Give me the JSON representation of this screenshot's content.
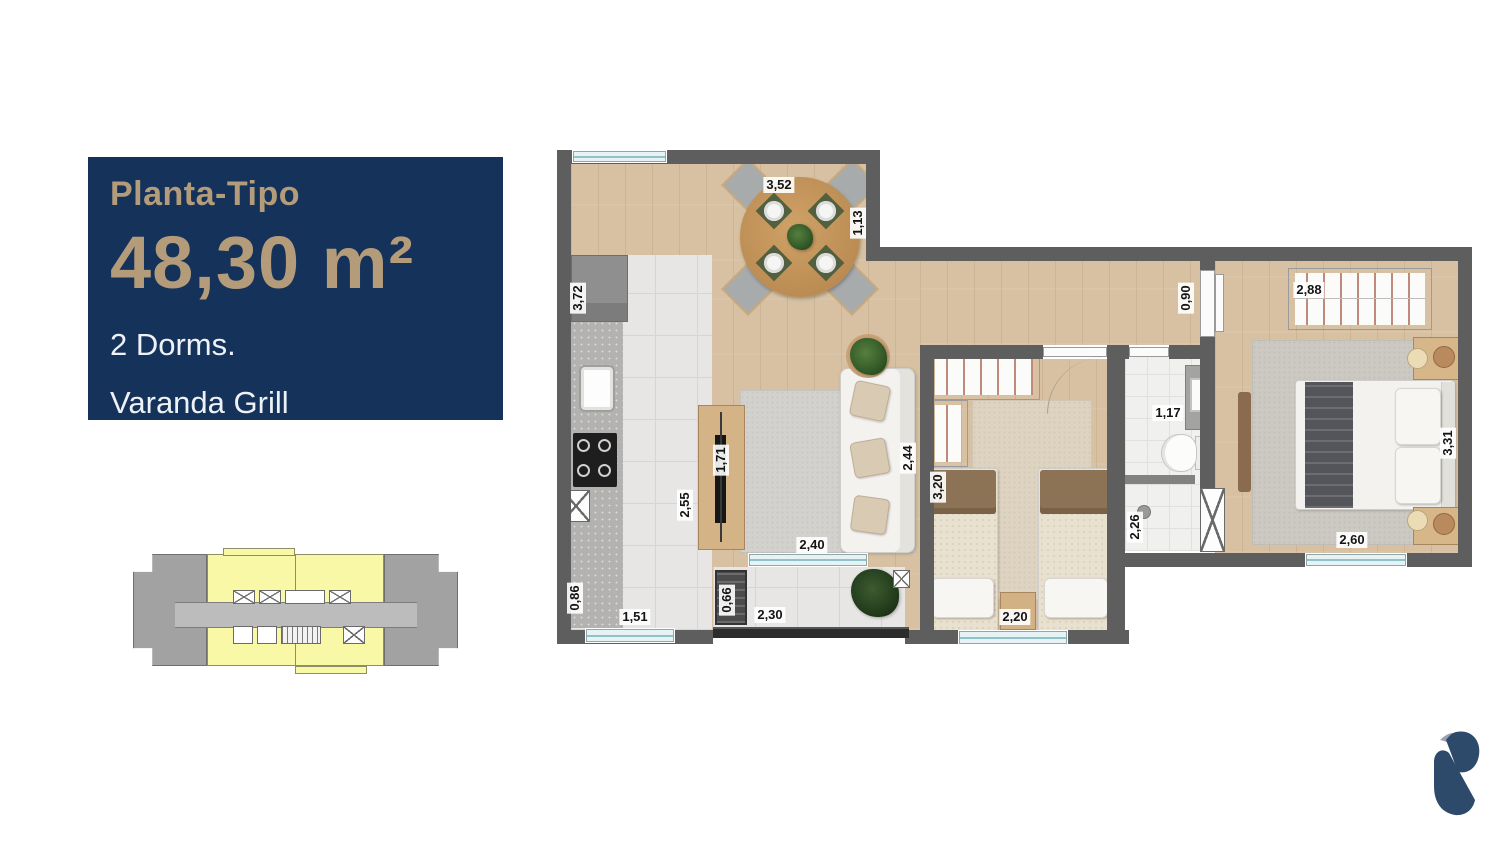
{
  "info_panel": {
    "title": "Planta-Tipo",
    "area": "48,30 m²",
    "dorms": "2 Dorms.",
    "feature": "Varanda Grill",
    "bg_color": "#15325a",
    "accent_color": "#b49b79"
  },
  "dimensions": {
    "dining_width": "3,52",
    "dining_depth": "1,13",
    "kitchen_height": "3,72",
    "kitchen_length": "2,55",
    "kitchen_entry": "0,86",
    "kitchen_window": "1,51",
    "tv_panel": "1,71",
    "living_depth": "2,44",
    "living_width": "2,40",
    "grill_width": "0,66",
    "varanda_width": "2,30",
    "bedroom2_depth": "3,20",
    "bedroom2_width": "2,20",
    "hall_width": "0,90",
    "bath_width": "1,17",
    "bath_depth": "2,26",
    "master_wardrobe_width": "2,88",
    "master_depth": "3,31",
    "master_width": "2,60"
  },
  "key_plan": {
    "highlight_color": "#f8f8a6",
    "muted_color": "#a2a2a2"
  },
  "plan_colors": {
    "wall": "#5e5e5e",
    "wood_floor": "#d7c1a2",
    "tile_floor": "#e7e6e4"
  },
  "logo": {
    "color": "#2e4a6b",
    "accent": "#99a1b0"
  }
}
